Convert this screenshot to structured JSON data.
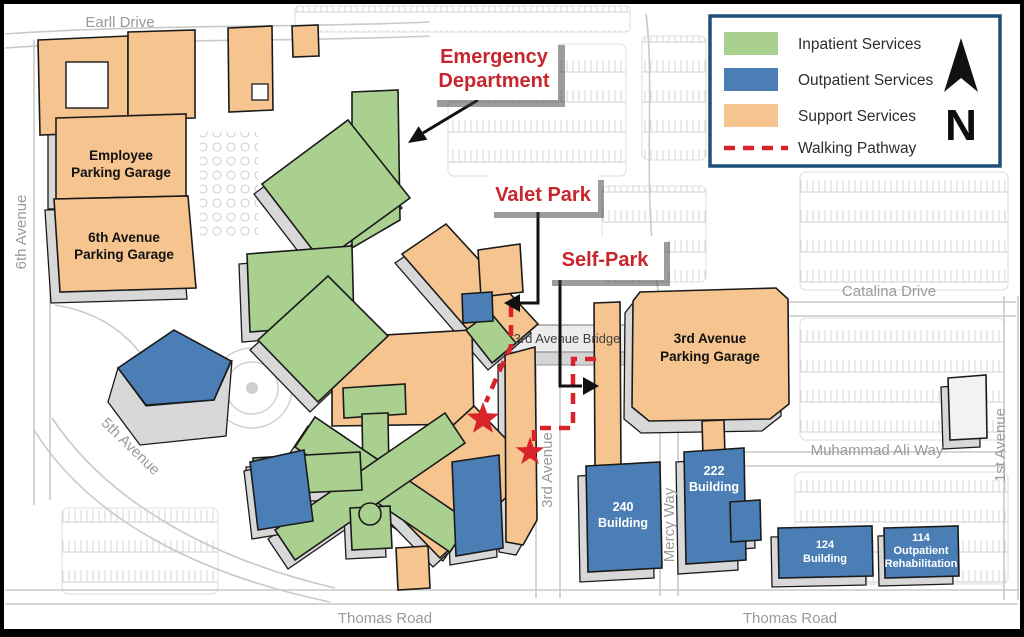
{
  "colors": {
    "inpatient": "#a9d08e",
    "outpatient": "#4a7eb5",
    "support": "#f6c48f",
    "pathway": "#d8232a",
    "callout_text": "#c9252d",
    "legend_border": "#1f4e79",
    "road": "#c9c9c9",
    "street_text": "#9a9a9a",
    "base3d": "#d8d8d8"
  },
  "legend": {
    "items": [
      {
        "key": "inpatient",
        "label": "Inpatient Services"
      },
      {
        "key": "outpatient",
        "label": "Outpatient Services"
      },
      {
        "key": "support",
        "label": "Support Services"
      },
      {
        "key": "pathway",
        "label": "Walking Pathway"
      }
    ],
    "north": "N"
  },
  "callouts": {
    "emergency": {
      "line1": "Emergency",
      "line2": "Department"
    },
    "valet": {
      "label": "Valet Park"
    },
    "selfpark": {
      "label": "Self-Park"
    }
  },
  "buildings": {
    "employee_garage": {
      "line1": "Employee",
      "line2": "Parking Garage"
    },
    "sixth_garage": {
      "line1": "6th Avenue",
      "line2": "Parking Garage"
    },
    "third_garage": {
      "line1": "3rd Avenue",
      "line2": "Parking Garage"
    },
    "bridge": {
      "label": "3rd Avenue Bridge"
    },
    "b240": {
      "line1": "240",
      "line2": "Building"
    },
    "b222": {
      "line1": "222",
      "line2": "Building"
    },
    "b124": {
      "line1": "124",
      "line2": "Building"
    },
    "b114": {
      "line1": "114",
      "line2": "Outpatient",
      "line3": "Rehabilitation"
    }
  },
  "streets": {
    "earll": "Earll Drive",
    "sixth": "6th Avenue",
    "fifth": "5th Avenue",
    "third": "3rd Avenue",
    "first": "1st Avenue",
    "catalina": "Catalina Drive",
    "muhammad": "Muhammad Ali Way",
    "mercy": "Mercy Way",
    "thomas_west": "Thomas Road",
    "thomas_east": "Thomas Road"
  }
}
